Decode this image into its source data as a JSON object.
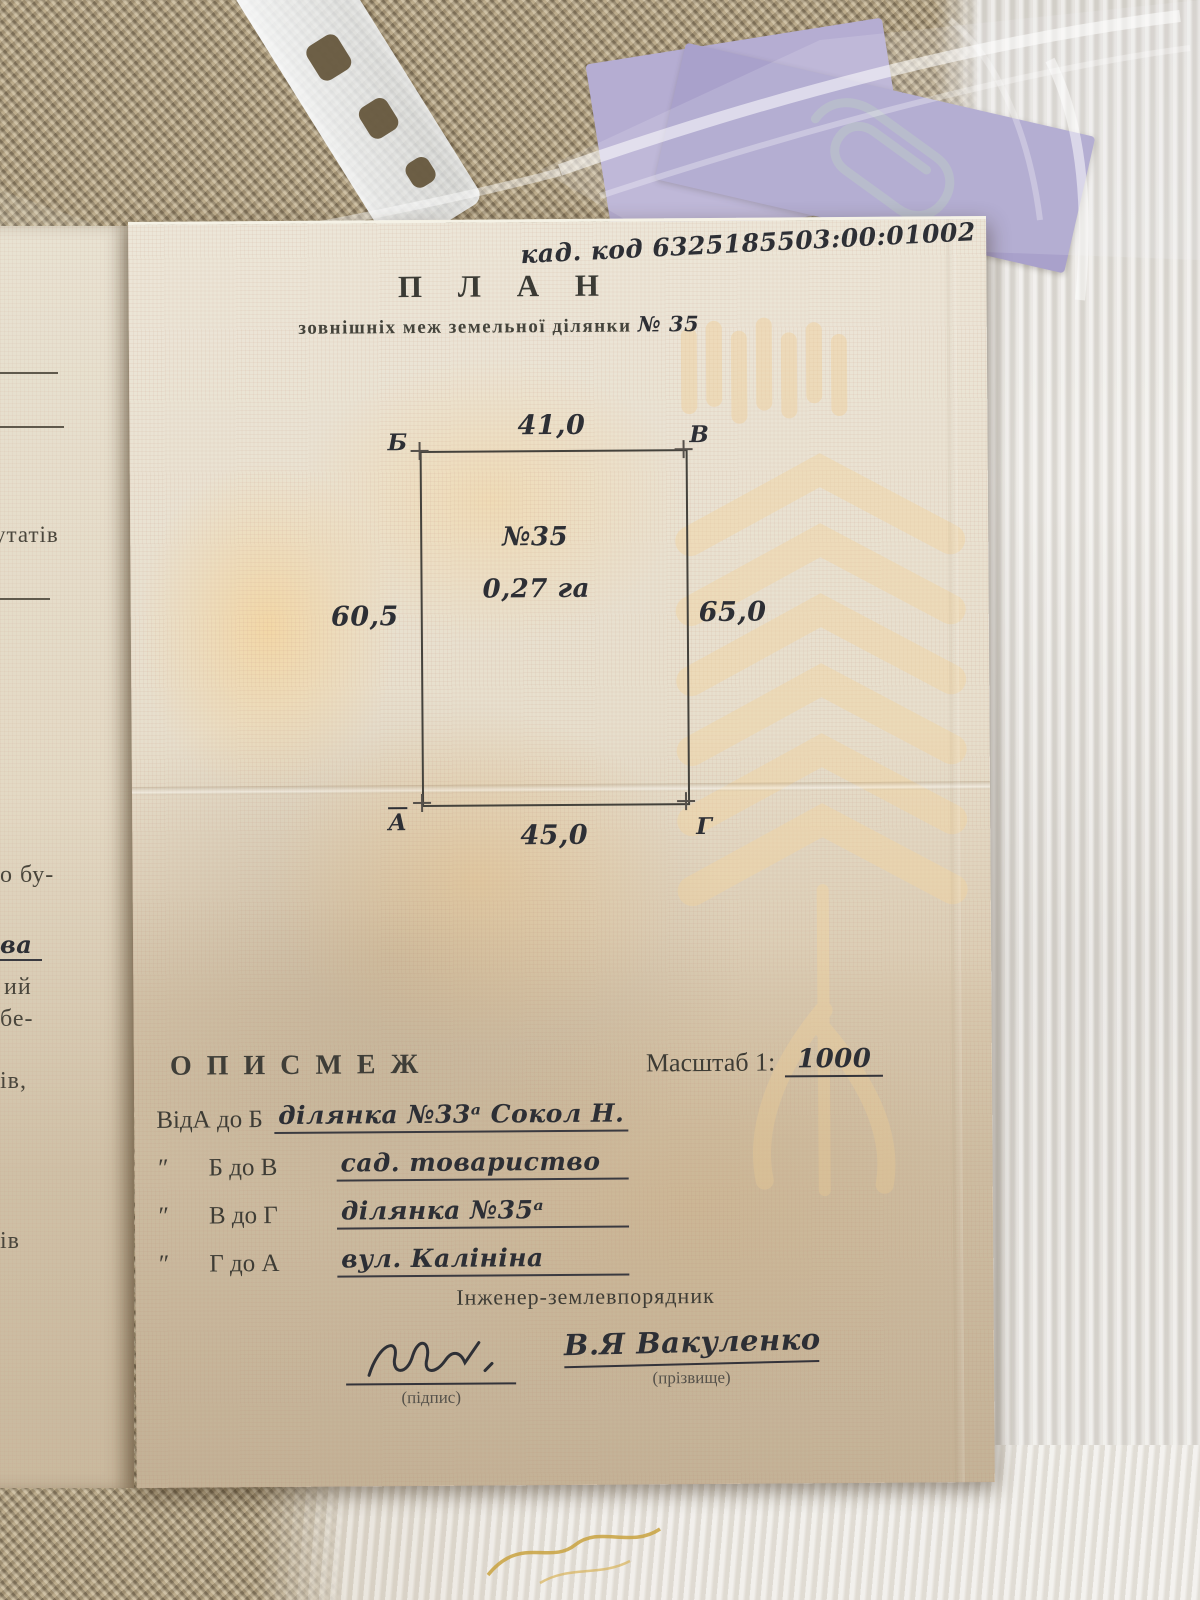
{
  "colors": {
    "paper": "#e9e2d2",
    "paper_shadow": "#d2c2a8",
    "watermark_orange": "#f3d7a6",
    "print_ink": "#3e3c35",
    "handwriting_ink": "#2d2f35",
    "purple_paper": "#afa7cf",
    "placemat": "#a3947a",
    "fabric": "#e7e3dd"
  },
  "document": {
    "cadastral_code": "кад. код 6325185503:00:01002",
    "title": "П Л А Н",
    "subtitle": "зовнішніх меж земельної ділянки",
    "subtitle_number": "№ 35",
    "plot": {
      "number": "№35",
      "area": "0,27 га",
      "side_top": "41,0",
      "side_bottom": "45,0",
      "side_left": "60,5",
      "side_right": "65,0",
      "corner_top_left": "Б",
      "corner_top_right": "В",
      "corner_bottom_left": "А",
      "corner_bottom_right": "Г"
    },
    "description": {
      "heading": "О П И С   М Е Ж",
      "scale_label": "Масштаб 1:",
      "scale_value": "1000",
      "rows": [
        {
          "prefix": "Від",
          "segment": "А до Б",
          "value": "ділянка №33ᵃ  Сокол Н."
        },
        {
          "prefix": "″",
          "segment": "Б до В",
          "value": "сад. товариство"
        },
        {
          "prefix": "″",
          "segment": "В до Г",
          "value": "ділянка №35ᵃ"
        },
        {
          "prefix": "″",
          "segment": "Г до А",
          "value": "вул. Калініна"
        }
      ]
    },
    "engineer": {
      "role": "Інженер-землевпорядник",
      "signature_caption": "(підпис)",
      "name": "В.Я Вакуленко",
      "name_caption": "(прізвище)"
    },
    "left_page_fragments": [
      "утатів",
      "о бу-",
      "ва",
      "ий",
      "бе-",
      "ів,",
      "ів"
    ]
  }
}
